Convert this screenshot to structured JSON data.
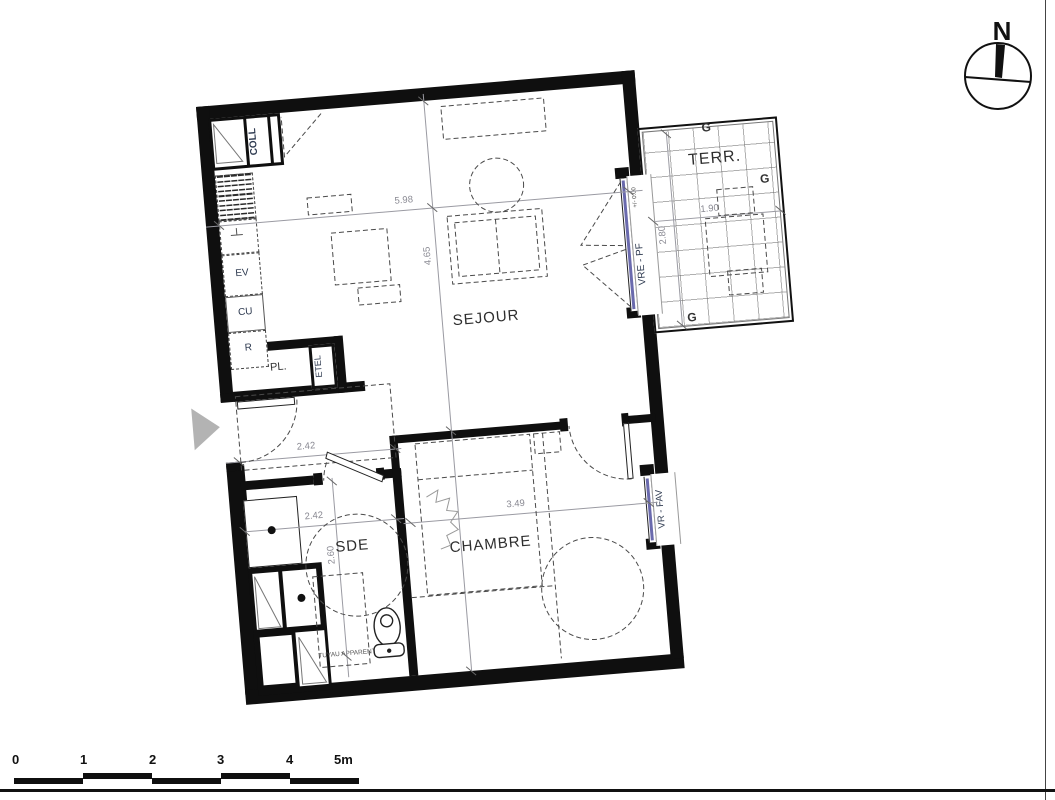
{
  "compass": {
    "north": "N"
  },
  "scale_bar": {
    "labels": [
      "0",
      "1",
      "2",
      "3",
      "4",
      "5m"
    ]
  },
  "rooms": {
    "sejour": "SEJOUR",
    "chambre": "CHAMBRE",
    "sde": "SDE",
    "terrace": "TERR."
  },
  "kitchen": {
    "coll": "COLL",
    "ev": "EV",
    "cu": "CU",
    "r": "R"
  },
  "entry": {
    "pl": "PL.",
    "etel": "ETEL"
  },
  "openings": {
    "sejour_window": "VRE - PF",
    "chambre_window": "VR - FAV",
    "level_mark": "+/- 0.00"
  },
  "terrace": {
    "gutter_mark": "G"
  },
  "notes": {
    "tuyau": "TUYAU APPARENT"
  },
  "dimensions": {
    "sejour_width": "5.98",
    "sejour_depth": "4.65",
    "entry_width": "2.42",
    "sde_width": "2.42",
    "sde_depth": "2.60",
    "chambre_width": "3.49",
    "terrace_width": "1.90",
    "terrace_depth": "2.80"
  },
  "colors": {
    "wall": "#0f0f0f",
    "glazing": "#6a6aad",
    "dimension_text": "#8a8a93",
    "label_text": "#2e3a50"
  }
}
